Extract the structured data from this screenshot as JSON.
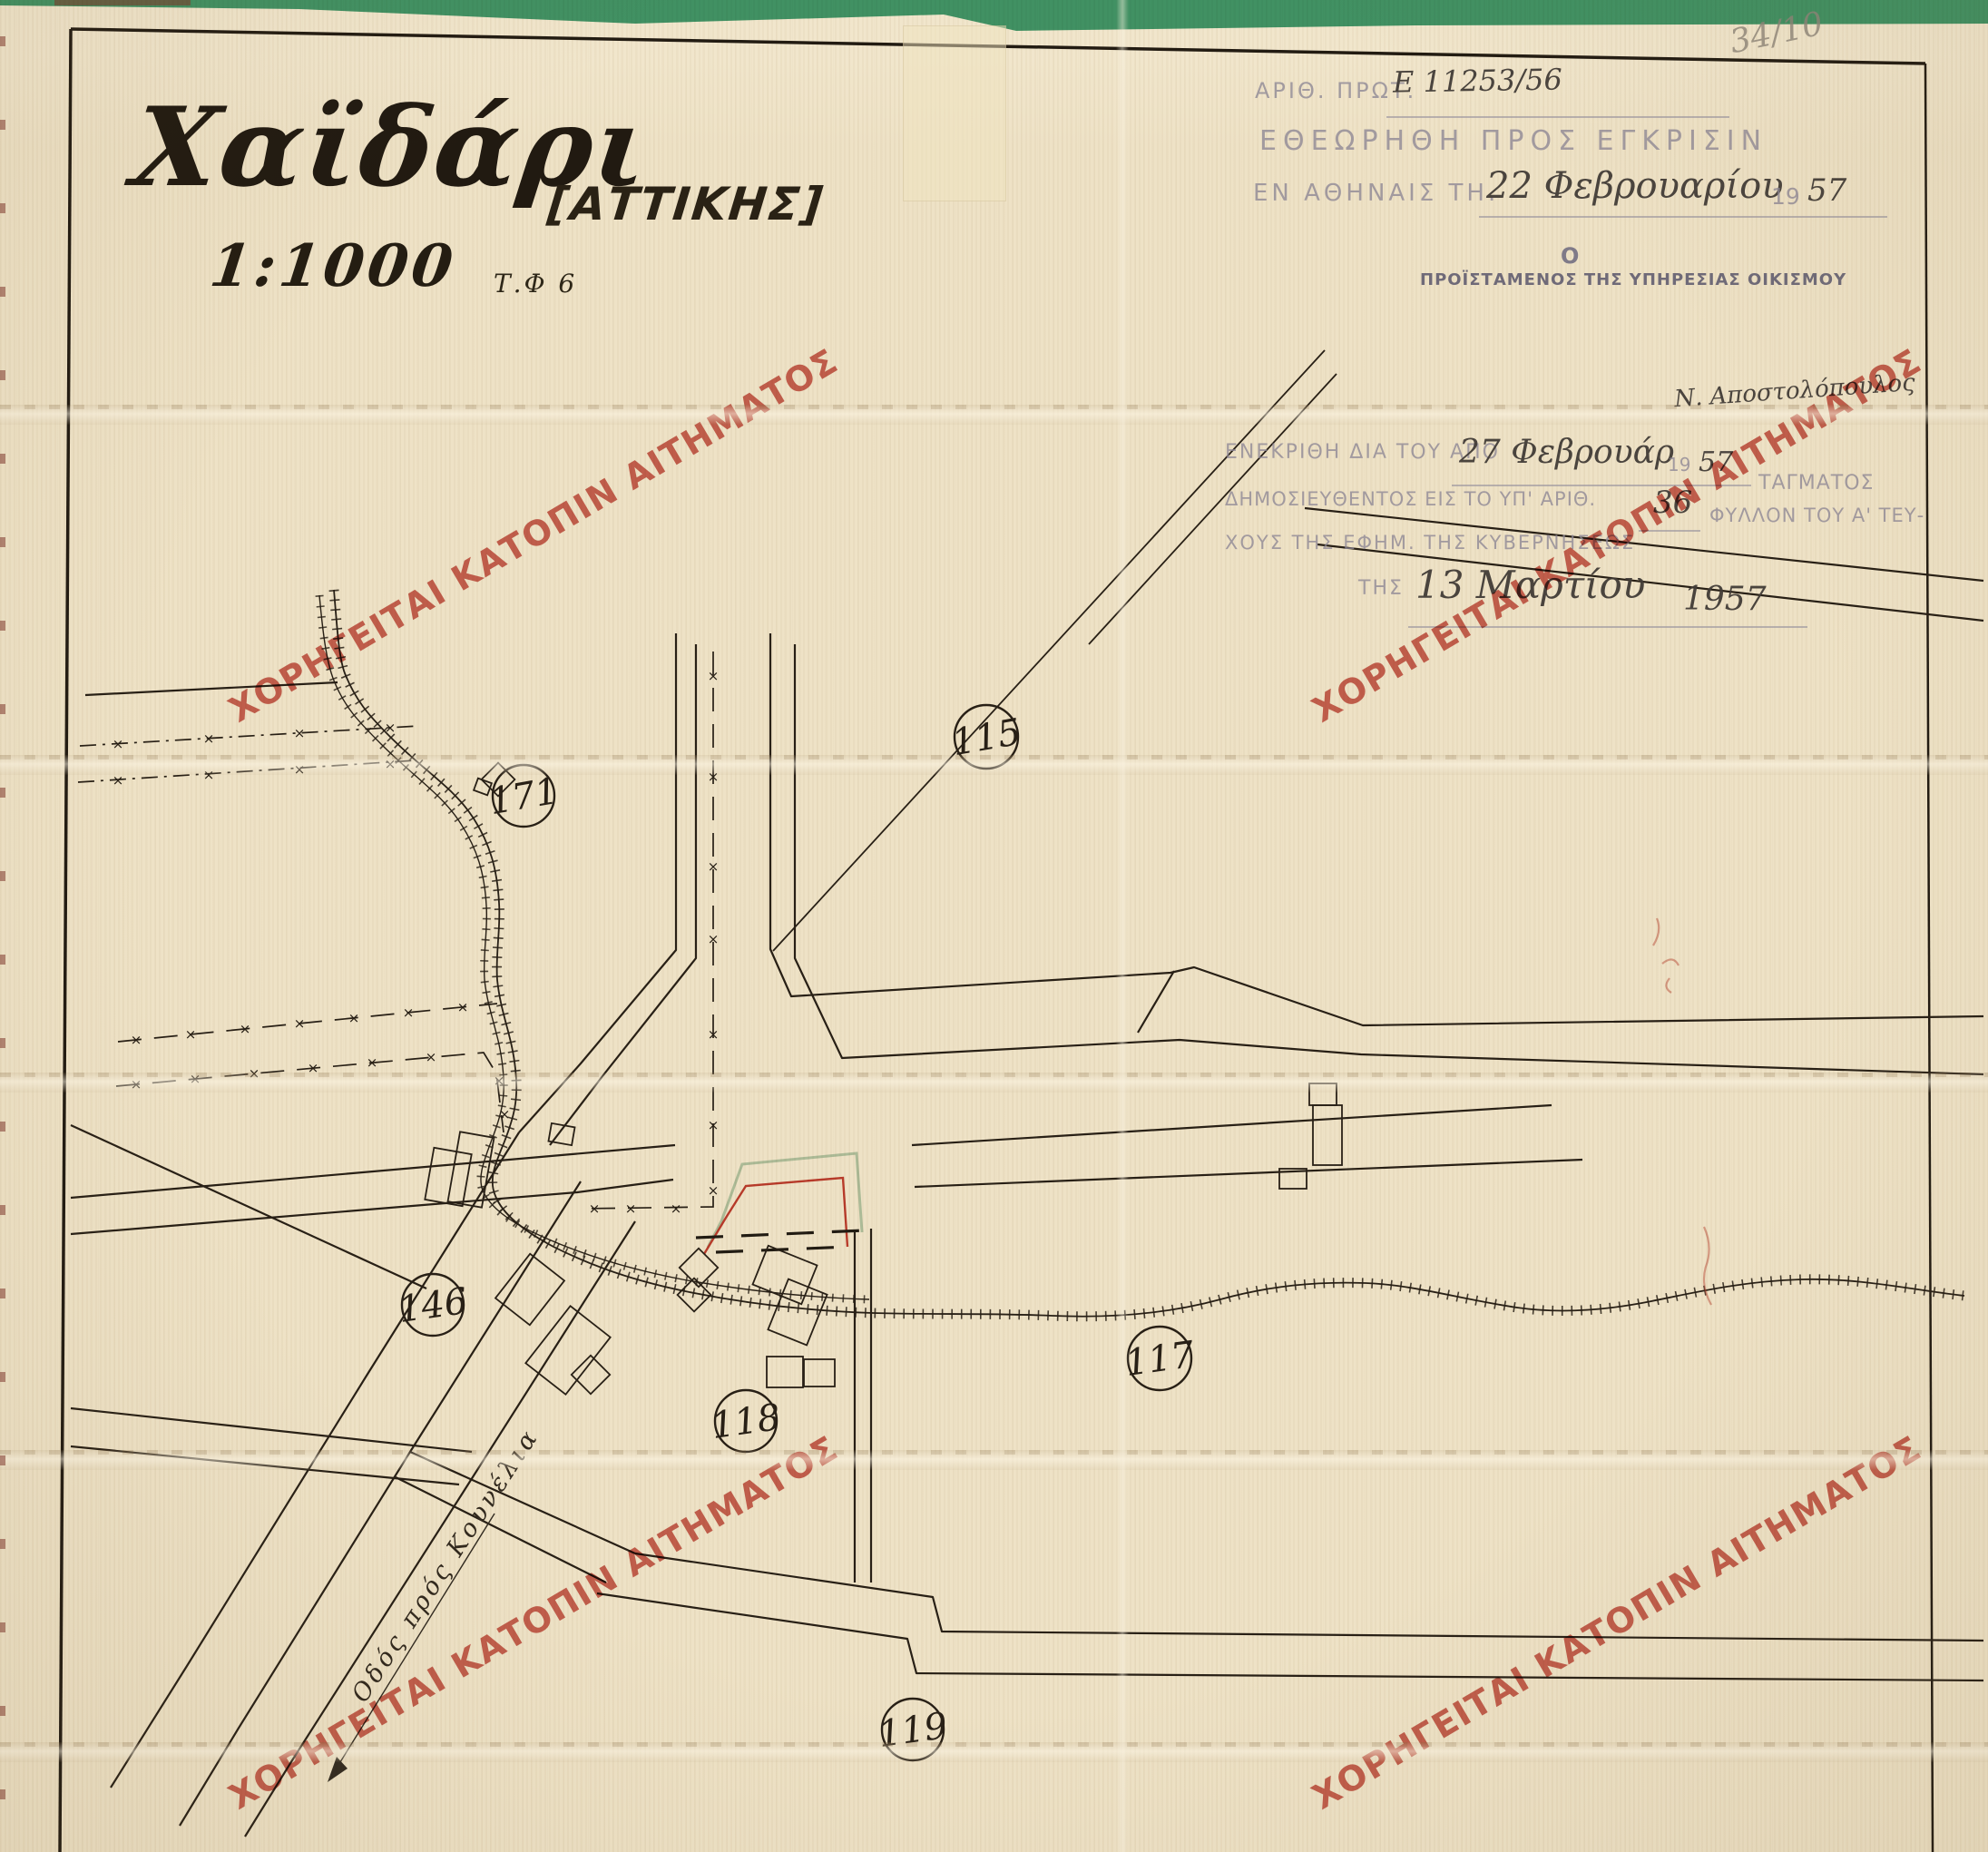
{
  "title": {
    "name": "Χαϊδάρι",
    "region": "[ΑΤΤΙΚΗΣ]",
    "scale": "1:1000",
    "sheet_ref": "Τ.Φ 6"
  },
  "corner_note": "34/10",
  "stamp_top": {
    "protocol_label": "ΑΡΙΘ. ΠΡΩΤ.",
    "protocol_value": "Ε 11253/56",
    "heading": "ΕΘΕΩΡΗΘΗ ΠΡΟΣ ΕΓΚΡΙΣΙΝ",
    "place_label": "ΕΝ ΑΘΗΝΑΙΣ ΤΗ.",
    "date_value": "22 Φεβρουαρίου",
    "year_printed": "19",
    "year_value": "57",
    "officer_article": "Ο",
    "officer_title": "ΠΡΟΪΣΤΑΜΕΝΟΣ ΤΗΣ ΥΠΗΡΕΣΙΑΣ ΟΙΚΙΣΜΟΥ"
  },
  "stamp_approval": {
    "signature": "Ν. Αποστολόπουλος",
    "line1_label": "ΕΝΕΚΡΙΘΗ ΔΙΑ ΤΟΥ ΑΠΟ",
    "line1_value": "27 Φεβρουάρ",
    "line1_year_printed": "19",
    "line1_year_value": "57",
    "line1_tail": "ΤΑΓΜΑΤΟΣ",
    "line2_label": "ΔΗΜΟΣΙΕΥΘΕΝΤΟΣ ΕΙΣ ΤΟ ΥΠ' ΑΡΙΘ.",
    "line2_value": "36",
    "line2_tail": "ΦΥΛΛΟΝ ΤΟΥ Α' ΤΕΥ-",
    "line3": "ΧΟΥΣ ΤΗΣ ΕΦΗΜ. ΤΗΣ ΚΥΒΕΡΝΗΣΕΩΣ",
    "line4_label": "ΤΗΣ",
    "line4_value": "13 Μαρτίου",
    "line4_year": "1957"
  },
  "watermark": {
    "text": "ΧΟΡΗΓΕΙΤΑΙ ΚΑΤΟΠΙΝ ΑΙΤΗΜΑΤΟΣ",
    "color": "#c75248"
  },
  "map": {
    "street_label": "Οδός πρός Κουνέλια",
    "blocks": [
      {
        "label": "171"
      },
      {
        "label": "115"
      },
      {
        "label": "146"
      },
      {
        "label": "117"
      },
      {
        "label": "118"
      },
      {
        "label": "119"
      }
    ]
  },
  "colors": {
    "paper": "#eee2c6",
    "ink": "#2b241c",
    "stamp_ink": "#8d8795",
    "green_band": "#44a17c",
    "red_parcel": "#c54236",
    "teal_parcel": "#a8c8b4",
    "watermark_red": "#c75248"
  }
}
